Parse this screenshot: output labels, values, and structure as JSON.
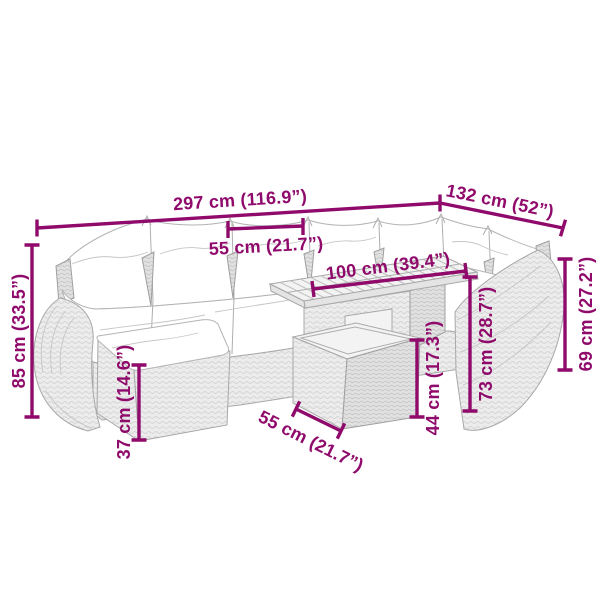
{
  "labels": {
    "total_width": "297 cm (116.9”)",
    "side_width": "132 cm (52”)",
    "seat_width": "55 cm (21.7”)",
    "table_length": "100 cm (39.4”)",
    "back_height": "85 cm (33.5”)",
    "ottoman_height": "37 cm (14.6”)",
    "table_depth": "55 cm (21.7”)",
    "table_base_height": "44 cm (17.3”)",
    "table_height": "73 cm (28.7”)",
    "arm_height": "69 cm (27.2”)"
  },
  "colors": {
    "dimension_magenta": "#8f0a6b",
    "furniture_gray": "#aeaeae",
    "background": "#ffffff"
  }
}
